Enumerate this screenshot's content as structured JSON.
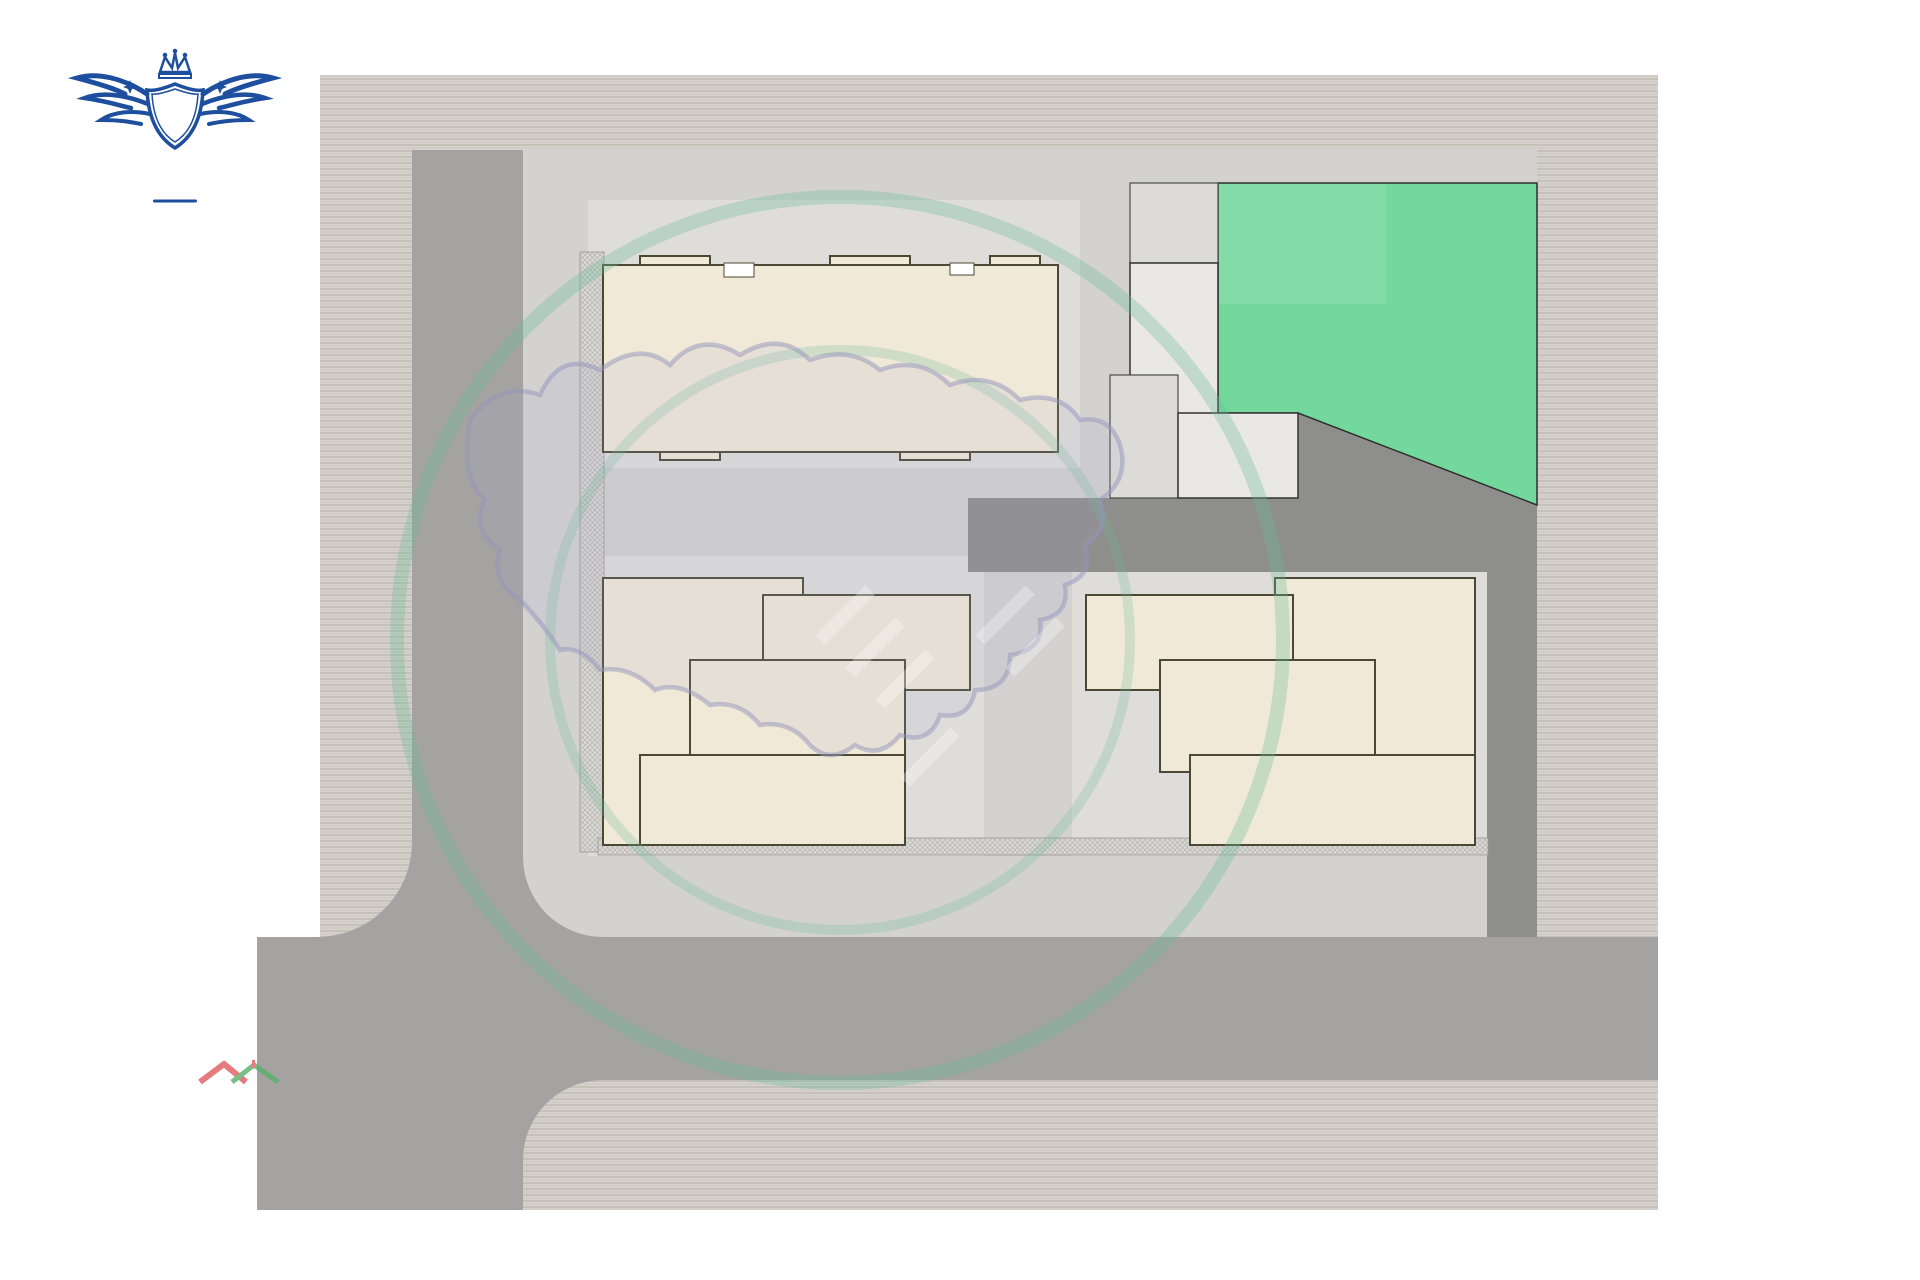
{
  "title": "VINCITORE RIVERA",
  "page_number": "10",
  "logo": {
    "monogram": "V",
    "floor_line": "10TH. FLOOR",
    "plan_line": "LAYOUT PLAN",
    "navy": "#1d4f9e",
    "orange": "#e8821e"
  },
  "roads": {
    "left": "40'00\"  WIDE  T.P.S ROAD",
    "bottom": "100'00\" WIDE  T.P.S  ROAD"
  },
  "plan": {
    "building_letters": [
      {
        "name": "building-c-letter",
        "text": "C",
        "x": 826,
        "y": 354
      },
      {
        "name": "building-b-letter",
        "text": "B",
        "x": 783,
        "y": 708
      },
      {
        "name": "building-a-letter",
        "text": "A",
        "x": 1268,
        "y": 708
      }
    ],
    "labels": [
      {
        "name": "unit-label-c1",
        "cls": "lbl-unit",
        "text": "3004",
        "x": 708,
        "y": 313
      },
      {
        "name": "unit-label-c2",
        "cls": "lbl-unit",
        "text": "1001",
        "x": 942,
        "y": 311
      },
      {
        "name": "unit-label-c3",
        "cls": "lbl-unit",
        "text": "3003",
        "x": 710,
        "y": 412
      },
      {
        "name": "unit-label-c4",
        "cls": "lbl-unit",
        "text": "1002",
        "x": 940,
        "y": 412
      },
      {
        "name": "open-terrace-c",
        "cls": "lbl-terrace2",
        "text": "OPEN TERRACE",
        "x": 1030,
        "y": 414
      },
      {
        "name": "unit-label-b1",
        "cls": "lbl-unit",
        "text": "3003",
        "x": 710,
        "y": 633
      },
      {
        "name": "open-terrace-b",
        "cls": "lbl-terrace",
        "text": "OPEN TERRACE",
        "x": 868,
        "y": 624
      },
      {
        "name": "lift-label-b1",
        "cls": "lbl-tiny",
        "text": "LIFT",
        "x": 705,
        "y": 690
      },
      {
        "name": "lift-label-b2",
        "cls": "lbl-tiny",
        "text": "LIFT",
        "x": 705,
        "y": 725
      },
      {
        "name": "up-label-b",
        "cls": "lbl-tiny",
        "text": "UP",
        "x": 830,
        "y": 689
      },
      {
        "name": "dn-label-b",
        "cls": "lbl-tiny",
        "text": "DN",
        "x": 830,
        "y": 728
      },
      {
        "name": "unit-label-b2",
        "cls": "lbl-unit",
        "text": "3002",
        "x": 712,
        "y": 785
      },
      {
        "name": "unit-label-b3",
        "cls": "lbl-unit",
        "text": "1001",
        "x": 862,
        "y": 785
      },
      {
        "name": "open-terrace-a",
        "cls": "lbl-terrace",
        "text": "OPEN TERRACE",
        "x": 1185,
        "y": 623
      },
      {
        "name": "unit-label-a1",
        "cls": "lbl-unit",
        "text": "1002",
        "x": 1345,
        "y": 630
      },
      {
        "name": "dn-label-a",
        "cls": "lbl-tiny",
        "text": "DN",
        "x": 1226,
        "y": 688
      },
      {
        "name": "up-label-a",
        "cls": "lbl-tiny",
        "text": "UP",
        "x": 1224,
        "y": 726
      },
      {
        "name": "lift-label-a1",
        "cls": "lbl-tiny",
        "text": "LIFT",
        "x": 1352,
        "y": 690
      },
      {
        "name": "lift-label-a2",
        "cls": "lbl-tiny",
        "text": "LIFT",
        "x": 1352,
        "y": 725
      },
      {
        "name": "unit-label-a2",
        "cls": "lbl-unit",
        "text": "3004",
        "x": 1193,
        "y": 787
      },
      {
        "name": "unit-label-a3",
        "cls": "lbl-unit",
        "text": "1003",
        "x": 1343,
        "y": 787
      }
    ]
  },
  "watermarks": {
    "rera_ring": "GUJARAT REAL ESTATE REGULATORY AUTHORITY",
    "guj_rera": "GUJ RERA",
    "site_url": "www.A2ZProperty.in",
    "a2z": "A2Z",
    "property_letters": [
      {
        "ch": "P",
        "color": "#5b8dd9"
      },
      {
        "ch": "r",
        "color": "#f0a23b"
      },
      {
        "ch": "o",
        "color": "#e9c83d"
      },
      {
        "ch": "p",
        "color": "#5b8dd9"
      },
      {
        "ch": "e",
        "color": "#56b563"
      },
      {
        "ch": "r",
        "color": "#f0a23b"
      },
      {
        "ch": "t",
        "color": "#e9c83d"
      },
      {
        "ch": "y",
        "color": "#72cfc3"
      }
    ]
  },
  "colors": {
    "road": "#a4a3a1",
    "driveway": "#8e8e8c",
    "plot": "#d3d2d0",
    "green_area": "#72d89c",
    "building_fill": "#f0e9d8",
    "room_fill": "#cdbe9e",
    "unit_red": "#9c3226",
    "letter_red": "#c32a1e"
  }
}
